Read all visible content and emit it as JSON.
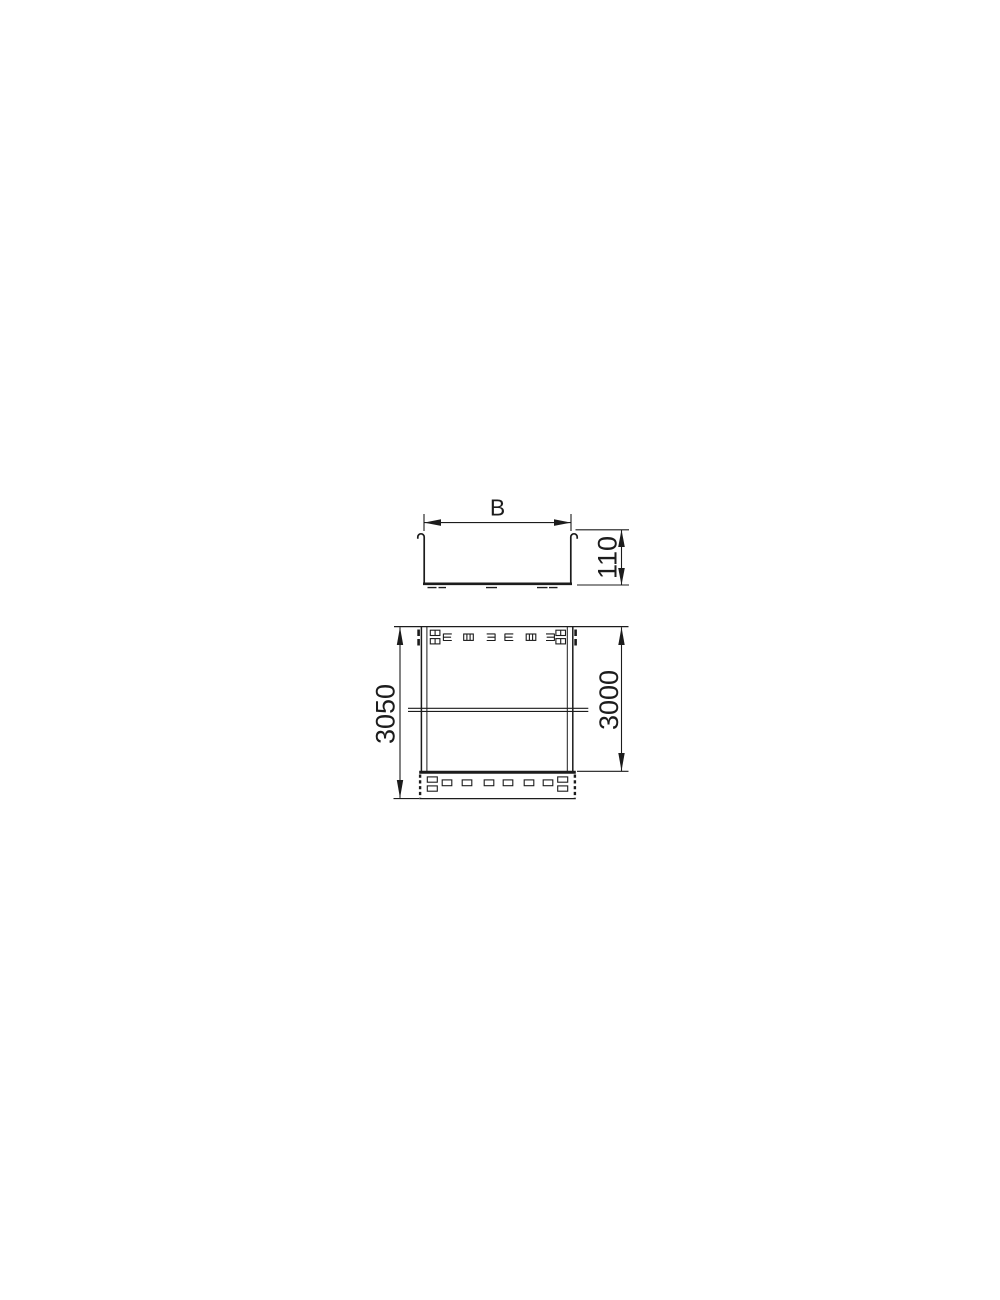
{
  "drawing": {
    "background": "#ffffff",
    "line_color": "#1c1c1c",
    "front_view": {
      "width_label": "B",
      "height_label": "110"
    },
    "plan_view": {
      "overall_length_label": "3050",
      "rail_length_label": "3000"
    }
  }
}
